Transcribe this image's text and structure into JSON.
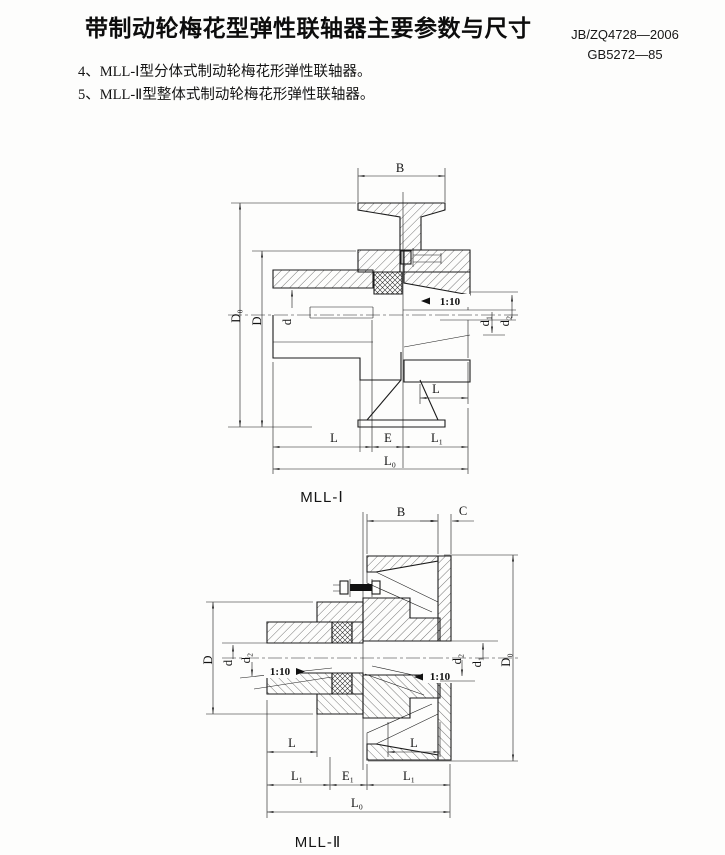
{
  "header": {
    "title": "带制动轮梅花型弹性联轴器主要参数与尺寸",
    "standard_1": "JB/ZQ4728—2006",
    "standard_2": "GB5272—85"
  },
  "notes": {
    "item_4": "4、MLL-Ⅰ型分体式制动轮梅花形弹性联轴器。",
    "item_5": "5、MLL-Ⅱ型整体式制动轮梅花形弹性联轴器。"
  },
  "figure1": {
    "caption": "MLL-Ⅰ",
    "dims": {
      "B": "B",
      "D0": "D₀",
      "D": "D",
      "d": "d",
      "taper": "1:10",
      "d1": "d₁",
      "d2": "d₂",
      "L_right": "L",
      "L": "L",
      "E": "E",
      "L1": "L₁",
      "L0": "L₀"
    }
  },
  "figure2": {
    "caption": "MLL-Ⅱ",
    "dims": {
      "B": "B",
      "C": "C",
      "D": "D",
      "d": "d",
      "d2_left": "d₂",
      "taper_left": "1:10",
      "taper_right": "1:10",
      "d2_right": "d₂",
      "d1": "d₁",
      "D0": "D₀",
      "L_left": "L",
      "L_right": "L",
      "L1_left": "L₁",
      "E1": "E₁",
      "L1_right": "L₁",
      "L0": "L₀"
    }
  }
}
